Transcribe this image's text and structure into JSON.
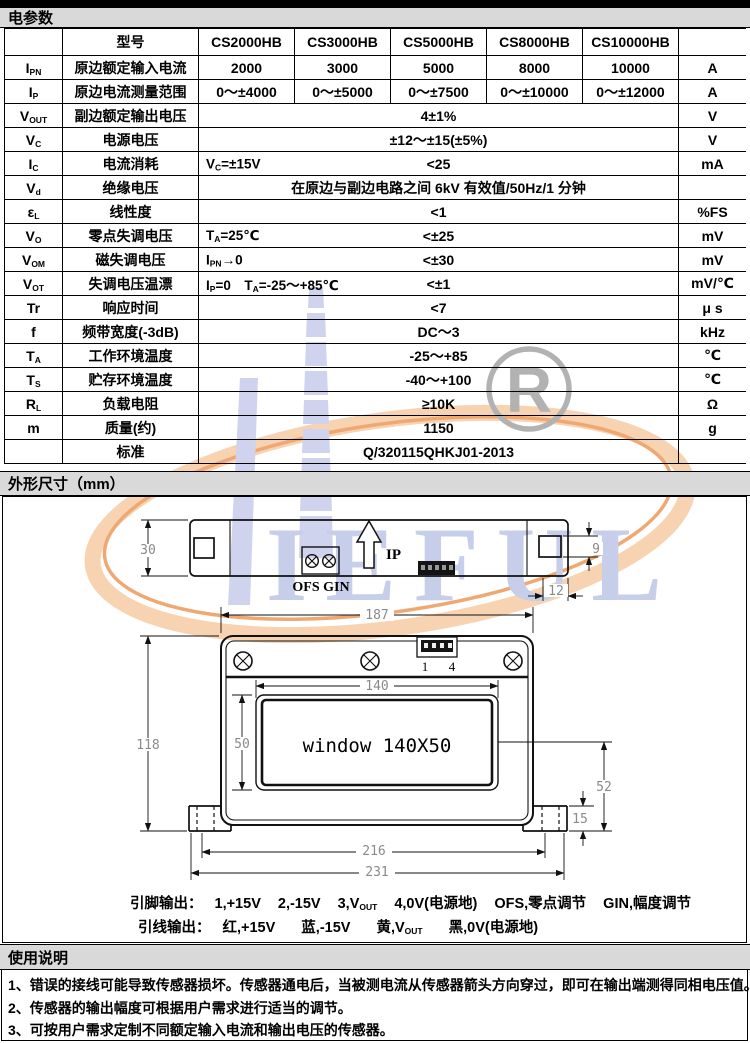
{
  "sections": {
    "electrical": "电参数",
    "outline": "外形尺寸（mm）",
    "usage": "使用说明"
  },
  "table": {
    "model_row_label": "型号",
    "models": [
      "CS2000HB",
      "CS3000HB",
      "CS5000HB",
      "CS8000HB",
      "CS10000HB"
    ],
    "rows": [
      {
        "sym": "{I|PN}",
        "name": "原边额定输入电流",
        "values": [
          "2000",
          "3000",
          "5000",
          "8000",
          "10000"
        ],
        "unit": "A"
      },
      {
        "sym": "{I|P}",
        "name": "原边电流测量范围",
        "values": [
          "0～±4000",
          "0～±5000",
          "0～±7500",
          "0～±10000",
          "0～±12000"
        ],
        "unit": "A"
      },
      {
        "sym": "{V|OUT}",
        "name": "副边额定输出电压",
        "value": "4±1%",
        "unit": "V"
      },
      {
        "sym": "{V|C}",
        "name": "电源电压",
        "value": "±12～±15(±5%)",
        "unit": "V"
      },
      {
        "sym": "{I|C}",
        "name": "电流消耗",
        "cond": "{V|C}=±15V",
        "value": "<25",
        "unit": "mA"
      },
      {
        "sym": "{V|d}",
        "name": "绝缘电压",
        "value": "在原边与副边电路之间 6kV 有效值/50Hz/1 分钟",
        "unit": ""
      },
      {
        "sym": "{ε|L}",
        "name": "线性度",
        "value": "<1",
        "unit": "%FS"
      },
      {
        "sym": "{V|O}",
        "name": "零点失调电压",
        "cond": "{T|A}=25℃",
        "value": "<±25",
        "unit": "mV"
      },
      {
        "sym": "{V|OM}",
        "name": "磁失调电压",
        "cond": "{I|PN}→0",
        "value": "<±30",
        "unit": "mV"
      },
      {
        "sym": "{V|OT}",
        "name": "失调电压温漂",
        "cond": "{I|P}=0　{T|A}=-25～+85℃",
        "value": "<±1",
        "unit": "mV/℃"
      },
      {
        "sym": "Tr",
        "name": "响应时间",
        "value": "<7",
        "unit": "μ s"
      },
      {
        "sym": "f",
        "name": "频带宽度(-3dB)",
        "value": "DC～3",
        "unit": "kHz"
      },
      {
        "sym": "{T|A}",
        "name": "工作环境温度",
        "value": "-25～+85",
        "unit": "℃"
      },
      {
        "sym": "{T|S}",
        "name": "贮存环境温度",
        "value": "-40～+100",
        "unit": "℃"
      },
      {
        "sym": "{R|L}",
        "name": "负载电阻",
        "value": "≥10K",
        "unit": "Ω"
      },
      {
        "sym": "m",
        "name": "质量(约)",
        "value": "1150",
        "unit": "g"
      },
      {
        "sym": "",
        "name": "标准",
        "value": "Q/320115QHKJ01-2013",
        "unit": ""
      }
    ]
  },
  "drawing": {
    "side_view": {
      "dim_height": "30",
      "dim_hole": "9",
      "dim_foot": "12",
      "terminal_label": "OFS GIN",
      "arrow_label": "IP"
    },
    "front_view": {
      "dim_width": "187",
      "dim_window_w": "140",
      "dim_window_h": "50",
      "dim_height": "118",
      "dim_drop": "52",
      "dim_flange": "15",
      "dim_mount": "216",
      "dim_overall": "231",
      "window_label": "window 140X50",
      "pin_first": "1",
      "pin_last": "4"
    }
  },
  "pinout": {
    "pin_label": "引脚输出：",
    "pins": [
      "1,+15V",
      "2,-15V",
      "3,{V|OUT}",
      "4,0V(电源地)",
      "OFS,零点调节",
      "GIN,幅度调节"
    ],
    "wire_label": "引线输出：",
    "wires": [
      "红,+15V",
      "蓝,-15V",
      "黄,{V|OUT}",
      "黑,0V(电源地)"
    ]
  },
  "notes": [
    "1、错误的接线可能导致传感器损坏。传感器通电后，当被测电流从传感器箭头方向穿过，即可在输出端测得同相电压值。",
    "2、传感器的输出幅度可根据用户需求进行适当的调节。",
    "3、可按用户需求定制不同额定输入电流和输出电压的传感器。"
  ],
  "watermark": {
    "letters": "IEFUL",
    "r_mark": "R",
    "colors": {
      "lavender": "#cfd3ee",
      "letter_blue": "#c7cee9",
      "peach": "#f7cda9",
      "orange": "#f0a873",
      "gray": "#b2b2b2"
    }
  }
}
